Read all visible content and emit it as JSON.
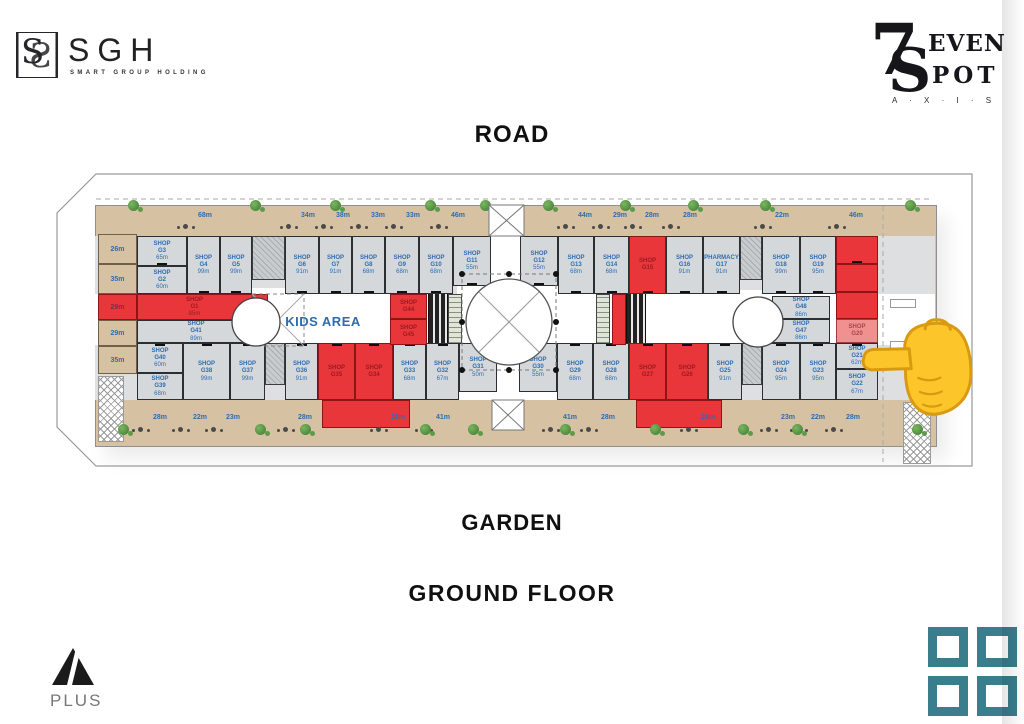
{
  "branding": {
    "sgh": {
      "monogram": "S",
      "name": "SGH",
      "tagline": "SMART GROUP HOLDING"
    },
    "seven_spot": {
      "numeral": "7",
      "letter": "S",
      "word_top": "EVEN",
      "word_bottom": "POT",
      "tagline": "A · X · I · S"
    },
    "a_plus": {
      "name": "PLUS"
    }
  },
  "labels": {
    "road": "ROAD",
    "garden": "GARDEN",
    "floor_title": "GROUND FLOOR",
    "kids_area": "KIDS AREA"
  },
  "colors": {
    "red_unit": "#e8363b",
    "red_unit_light": "#f0908f",
    "shop_fill": "#d5d8db",
    "terrace_fill": "#d7c1a3",
    "label_blue": "#2e6cb0",
    "teal_logo": "#3a7d8c",
    "hand_yellow": "#fcc62b"
  },
  "plan": {
    "shops": [
      {
        "u": "SHOP G3",
        "a": "65m",
        "x": 137,
        "y": 236,
        "w": 50,
        "h": 30,
        "s": "n"
      },
      {
        "u": "SHOP G2",
        "a": "60m",
        "x": 137,
        "y": 266,
        "w": 50,
        "h": 28,
        "s": "n"
      },
      {
        "u": "SHOP G4",
        "a": "99m",
        "x": 187,
        "y": 236,
        "w": 33,
        "h": 58,
        "s": "n"
      },
      {
        "u": "SHOP G5",
        "a": "99m",
        "x": 220,
        "y": 236,
        "w": 32,
        "h": 58,
        "s": "n"
      },
      {
        "u": "SHOP G6",
        "a": "91m",
        "x": 285,
        "y": 236,
        "w": 34,
        "h": 58,
        "s": "n"
      },
      {
        "u": "SHOP G7",
        "a": "91m",
        "x": 319,
        "y": 236,
        "w": 33,
        "h": 58,
        "s": "n"
      },
      {
        "u": "SHOP G8",
        "a": "68m",
        "x": 352,
        "y": 236,
        "w": 33,
        "h": 58,
        "s": "n"
      },
      {
        "u": "SHOP G9",
        "a": "68m",
        "x": 385,
        "y": 236,
        "w": 34,
        "h": 58,
        "s": "n"
      },
      {
        "u": "SHOP G10",
        "a": "68m",
        "x": 419,
        "y": 236,
        "w": 34,
        "h": 58,
        "s": "n"
      },
      {
        "u": "SHOP G11",
        "a": "55m",
        "x": 453,
        "y": 236,
        "w": 38,
        "h": 50,
        "s": "n"
      },
      {
        "u": "SHOP G12",
        "a": "55m",
        "x": 520,
        "y": 236,
        "w": 38,
        "h": 50,
        "s": "n"
      },
      {
        "u": "SHOP G13",
        "a": "68m",
        "x": 558,
        "y": 236,
        "w": 36,
        "h": 58,
        "s": "n"
      },
      {
        "u": "SHOP G14",
        "a": "68m",
        "x": 594,
        "y": 236,
        "w": 35,
        "h": 58,
        "s": "n"
      },
      {
        "u": "SHOP G15",
        "a": "",
        "x": 629,
        "y": 236,
        "w": 37,
        "h": 58,
        "s": "r"
      },
      {
        "u": "SHOP G16",
        "a": "91m",
        "x": 666,
        "y": 236,
        "w": 37,
        "h": 58,
        "s": "n"
      },
      {
        "u": "PHARMACY G17",
        "a": "91m",
        "x": 703,
        "y": 236,
        "w": 37,
        "h": 58,
        "s": "n"
      },
      {
        "u": "SHOP G18",
        "a": "99m",
        "x": 762,
        "y": 236,
        "w": 38,
        "h": 58,
        "s": "n"
      },
      {
        "u": "SHOP G19",
        "a": "95m",
        "x": 800,
        "y": 236,
        "w": 36,
        "h": 58,
        "s": "n"
      },
      {
        "u": "",
        "a": "",
        "x": 836,
        "y": 236,
        "w": 42,
        "h": 28,
        "s": "r"
      },
      {
        "u": "",
        "a": "",
        "x": 836,
        "y": 264,
        "w": 42,
        "h": 28,
        "s": "r"
      },
      {
        "u": "",
        "a": "",
        "x": 836,
        "y": 292,
        "w": 42,
        "h": 27,
        "s": "r"
      },
      {
        "u": "SHOP G20",
        "a": "",
        "x": 836,
        "y": 319,
        "w": 42,
        "h": 24,
        "s": "rl"
      },
      {
        "u": "SHOP G1",
        "a": "85m",
        "x": 137,
        "y": 294,
        "w": 115,
        "h": 26,
        "s": "r"
      },
      {
        "u": "",
        "a": "",
        "x": 252,
        "y": 294,
        "w": 16,
        "h": 50,
        "s": "r"
      },
      {
        "u": "SHOP G41",
        "a": "89m",
        "x": 137,
        "y": 320,
        "w": 118,
        "h": 23,
        "s": "n"
      },
      {
        "u": "SHOP G40",
        "a": "60m",
        "x": 137,
        "y": 343,
        "w": 46,
        "h": 30,
        "s": "n"
      },
      {
        "u": "SHOP G39",
        "a": "68m",
        "x": 137,
        "y": 373,
        "w": 46,
        "h": 27,
        "s": "n"
      },
      {
        "u": "SHOP G38",
        "a": "99m",
        "x": 183,
        "y": 343,
        "w": 47,
        "h": 57,
        "s": "n"
      },
      {
        "u": "SHOP G37",
        "a": "99m",
        "x": 230,
        "y": 343,
        "w": 35,
        "h": 57,
        "s": "n"
      },
      {
        "u": "SHOP G36",
        "a": "91m",
        "x": 285,
        "y": 343,
        "w": 33,
        "h": 57,
        "s": "n"
      },
      {
        "u": "SHOP G35",
        "a": "",
        "x": 318,
        "y": 343,
        "w": 37,
        "h": 57,
        "s": "r"
      },
      {
        "u": "SHOP G34",
        "a": "",
        "x": 355,
        "y": 343,
        "w": 38,
        "h": 57,
        "s": "r"
      },
      {
        "u": "",
        "a": "",
        "x": 322,
        "y": 400,
        "w": 88,
        "h": 28,
        "s": "r"
      },
      {
        "u": "SHOP G33",
        "a": "68m",
        "x": 393,
        "y": 343,
        "w": 33,
        "h": 57,
        "s": "n"
      },
      {
        "u": "SHOP G32",
        "a": "67m",
        "x": 426,
        "y": 343,
        "w": 33,
        "h": 57,
        "s": "n"
      },
      {
        "u": "SHOP G31",
        "a": "50m",
        "x": 459,
        "y": 343,
        "w": 38,
        "h": 49,
        "s": "n"
      },
      {
        "u": "SHOP G30",
        "a": "55m",
        "x": 519,
        "y": 343,
        "w": 38,
        "h": 49,
        "s": "n"
      },
      {
        "u": "SHOP G29",
        "a": "68m",
        "x": 557,
        "y": 343,
        "w": 36,
        "h": 57,
        "s": "n"
      },
      {
        "u": "SHOP G28",
        "a": "68m",
        "x": 593,
        "y": 343,
        "w": 36,
        "h": 57,
        "s": "n"
      },
      {
        "u": "SHOP G27",
        "a": "",
        "x": 629,
        "y": 343,
        "w": 37,
        "h": 57,
        "s": "r"
      },
      {
        "u": "SHOP G26",
        "a": "",
        "x": 666,
        "y": 343,
        "w": 42,
        "h": 57,
        "s": "r"
      },
      {
        "u": "",
        "a": "",
        "x": 636,
        "y": 400,
        "w": 86,
        "h": 28,
        "s": "r"
      },
      {
        "u": "SHOP G25",
        "a": "91m",
        "x": 708,
        "y": 343,
        "w": 34,
        "h": 57,
        "s": "n"
      },
      {
        "u": "SHOP G24",
        "a": "95m",
        "x": 762,
        "y": 343,
        "w": 38,
        "h": 57,
        "s": "n"
      },
      {
        "u": "SHOP G23",
        "a": "95m",
        "x": 800,
        "y": 343,
        "w": 36,
        "h": 57,
        "s": "n"
      },
      {
        "u": "SHOP G21",
        "a": "62m",
        "x": 836,
        "y": 343,
        "w": 42,
        "h": 26,
        "s": "n"
      },
      {
        "u": "SHOP G22",
        "a": "67m",
        "x": 836,
        "y": 369,
        "w": 42,
        "h": 31,
        "s": "n"
      },
      {
        "u": "SHOP G44",
        "a": "",
        "x": 390,
        "y": 294,
        "w": 37,
        "h": 25,
        "s": "r"
      },
      {
        "u": "SHOP G45",
        "a": "",
        "x": 390,
        "y": 319,
        "w": 37,
        "h": 26,
        "s": "r"
      },
      {
        "u": "",
        "a": "",
        "x": 612,
        "y": 294,
        "w": 14,
        "h": 51,
        "s": "r"
      },
      {
        "u": "SHOP G48",
        "a": "86m",
        "x": 772,
        "y": 296,
        "w": 58,
        "h": 23,
        "s": "n"
      },
      {
        "u": "SHOP G47",
        "a": "86m",
        "x": 772,
        "y": 319,
        "w": 58,
        "h": 24,
        "s": "n"
      }
    ],
    "side_cells": [
      {
        "t": "26m",
        "y": 234,
        "h": 30,
        "red": false
      },
      {
        "t": "35m",
        "y": 264,
        "h": 30,
        "red": false
      },
      {
        "t": "29m",
        "y": 294,
        "h": 26,
        "red": true
      },
      {
        "t": "29m",
        "y": 320,
        "h": 26,
        "red": false
      },
      {
        "t": "35m",
        "y": 346,
        "h": 28,
        "red": false
      }
    ],
    "terraces_top": [
      [
        "68m",
        205
      ],
      [
        "34m",
        308
      ],
      [
        "38m",
        343
      ],
      [
        "33m",
        378
      ],
      [
        "33m",
        413
      ],
      [
        "46m",
        458
      ],
      [
        "44m",
        585
      ],
      [
        "29m",
        620
      ],
      [
        "28m",
        652
      ],
      [
        "28m",
        690
      ],
      [
        "22m",
        782
      ],
      [
        "46m",
        856
      ]
    ],
    "terraces_bottom": [
      [
        "28m",
        160
      ],
      [
        "22m",
        200
      ],
      [
        "23m",
        233
      ],
      [
        "28m",
        305
      ],
      [
        "28m",
        398
      ],
      [
        "41m",
        443
      ],
      [
        "41m",
        570
      ],
      [
        "28m",
        608
      ],
      [
        "28m",
        708
      ],
      [
        "23m",
        788
      ],
      [
        "22m",
        818
      ],
      [
        "28m",
        853
      ]
    ],
    "plants_top": [
      128,
      250,
      330,
      425,
      480,
      543,
      620,
      688,
      760,
      905
    ],
    "plants_bottom": [
      118,
      255,
      300,
      420,
      468,
      560,
      650,
      738,
      792,
      912
    ]
  }
}
